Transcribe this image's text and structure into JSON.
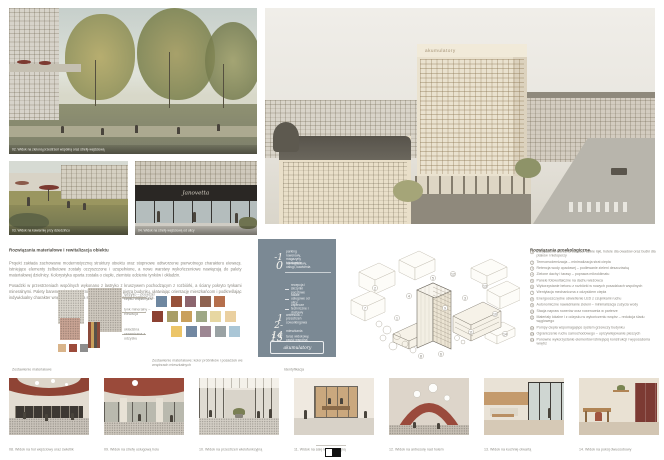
{
  "renders": {
    "courtyard": {
      "caption": "02. Widok na zieloną przestrzeń wspólną oraz strefę wejściową"
    },
    "cafe": {
      "caption": "03. Widok na kawiarnię przy dziedzińcu"
    },
    "storefront": {
      "caption": "04. Widok na strefę wejściową od ulicy",
      "sign": "Janovetta"
    },
    "city": {
      "tower_sign": "akumulatory"
    }
  },
  "materials": {
    "heading": "Rozwiązania materiałowe i rewitalizacja obiektu",
    "paragraph1": "Projekt zakłada zachowanie modernistycznej struktury obiektu oraz stopniowe odtworzenie pierwotnego charakteru elewacji. Istniejące elementy żelbetowe zostały oczyszczone i uzupełnione, a nowe warstwy wykończeniowe nawiązują do palety materiałowej dzielnicy. Kolorystyka oparta została o ciepłe, ziemiste odcienie tynków i okładzin.",
    "paragraph2": "Posadzki w przestrzeniach wspólnych wykonano z lastryko z kruszywem pochodzącym z rozbiórki, a ściany pokryto tynkami mineralnymi. Palety barwne mieszkań różnicują poszczególne piętra budynku, ułatwiając orientację mieszkańcom i podkreślając indywidualny charakter wnętrz. Drewniana stolarka uzupełnia całość kompozycji.",
    "collage_caption": "Zestawienie materiałowe",
    "palette_caption": "Zestawienie materiałowe: kolor próbników i posadzek we wnętrzach mieszkalnych",
    "labels": [
      "lastryko – posadzki części wspólnych",
      "tynk mineralny – elewacja",
      "okładzina ceramiczna z odzysku"
    ],
    "palette_rows": [
      [
        "#6e87a0",
        "#96513a",
        "#8c656e",
        "#8f6350",
        "#b56f4c"
      ],
      [
        "#8c4132",
        "#a89e67",
        "#c9a05c",
        "#9ea886",
        "#e7d7a2",
        "#ead0a0"
      ],
      [
        "#ecc568",
        "#7288a2",
        "#9d8793",
        "#9aa2a4",
        "#aac6d6"
      ]
    ]
  },
  "program": {
    "caption": "Identyfikacja",
    "panel_bg": "#7b8994",
    "floors": [
      {
        "level": "-1",
        "label": "parking rowerowy, magazyny lokatorskie"
      },
      {
        "level": "0",
        "label": "hol wejściowy, usługi, kawiarnia"
      },
      {
        "level": "1",
        "label": "antresola – przestrzeń coworkingowa"
      },
      {
        "level": "2-14",
        "label": "mieszkania"
      },
      {
        "level": "15",
        "label": "taras widokowy, część wspólna"
      }
    ],
    "sub_items": [
      "recepcja i skrzynki pocztowe",
      "lokale usługowe od ulicy",
      "zaplecze techniczne i dostawy"
    ],
    "box_label": "akumulatory"
  },
  "eco": {
    "heading": "Rozwiązania proekologiczne",
    "items": [
      {
        "n": "1",
        "text": "Zwiększenie bioróżnorodności: dzikie łąki, hotele dla owadów oraz budki dla ptaków i nietoperzy"
      },
      {
        "n": "2",
        "text": "Termomodernizacja – minimalizacja strat ciepła"
      },
      {
        "n": "3",
        "text": "Retencja wody opadowej – podlewanie zieleni deszczówką"
      },
      {
        "n": "4",
        "text": "Zielone dachy i tarasy – poprawa mikroklimatu"
      },
      {
        "n": "5",
        "text": "Panele fotowoltaiczne na dachu wieżowca"
      },
      {
        "n": "6",
        "text": "Wykorzystanie betonu z rozbiórki w nowych posadzkach wspólnych"
      },
      {
        "n": "7",
        "text": "Wentylacja mechaniczna z odzyskiem ciepła"
      },
      {
        "n": "8",
        "text": "Energooszczędne oświetlenie LED z czujnikami ruchu"
      },
      {
        "n": "9",
        "text": "Autonomiczne nawadnianie zieleni – minimalizacja zużycia wody"
      },
      {
        "n": "10",
        "text": "Stacja napraw rowerów oraz rowerownia w parterze"
      },
      {
        "n": "11",
        "text": "Materiały lokalne i z odzysku w wykończeniu wnętrz – redukcja śladu węglowego"
      },
      {
        "n": "12",
        "text": "Pompy ciepła wspomagające system grzewczy budynku"
      },
      {
        "n": "13",
        "text": "Ograniczenie ruchu samochodowego – uprzywilejowanie pieszych"
      },
      {
        "n": "14",
        "text": "Ponowne wykorzystanie elementów istniejącej konstrukcji i wyposażenia wnętrz"
      }
    ]
  },
  "bottom": {
    "captions": [
      "08. Widok na hol wejściowy oraz świetlik",
      "09. Widok na strefę usługową holu",
      "10. Widok na przestrzeń wielofunkcyjną",
      "11. Widok na salę konferencyjną",
      "12. Widok na antresolę nad holem",
      "13. Widok na kuchnię otwartą",
      "14. Widok na pokój dwuosobowy"
    ]
  }
}
